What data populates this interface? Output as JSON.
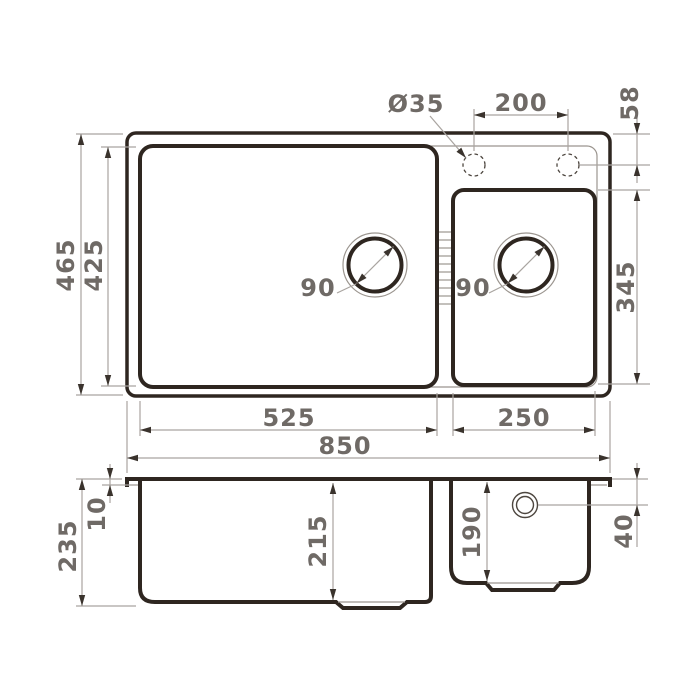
{
  "title": "Double-bowl kitchen sink dimensional drawing",
  "colors": {
    "outline": "#2e2620",
    "dim_line": "#a9a4a0",
    "dim_text": "#6f6a66",
    "arrow": "#3a332d",
    "background": "#ffffff"
  },
  "top_view": {
    "overall_width": "850",
    "left_bowl_width": "525",
    "right_bowl_width": "250",
    "overall_depth": "465",
    "inner_depth": "425",
    "right_bowl_depth": "345",
    "faucet_hole_diameter": "Ø35",
    "faucet_hole_spacing": "200",
    "faucet_hole_top_offset": "58",
    "left_drain_diameter": "90",
    "right_drain_diameter": "90"
  },
  "side_view": {
    "overall_height": "235",
    "rim_thickness": "10",
    "left_bowl_depth": "215",
    "right_bowl_depth": "190",
    "overflow_top_offset": "40"
  }
}
